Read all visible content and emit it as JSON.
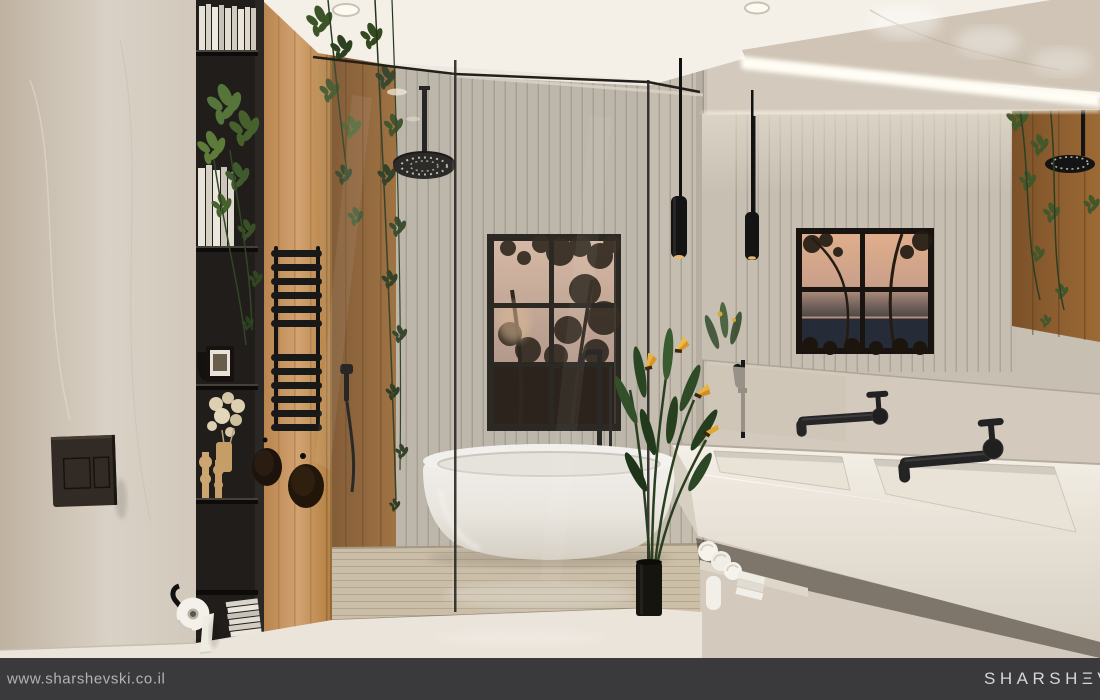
{
  "footer": {
    "website_url": "www.sharshevski.co.il",
    "brand_logo": "SHARSHΞVSKI",
    "bar_color": "#3a3a3c",
    "url_color": "#b3b3b3",
    "logo_color": "#d6d6d6"
  },
  "scene": {
    "type": "3d-interior-render",
    "room": "bathroom",
    "description": "Modern bathroom visualization: beige marble walls, black open shelving with books and decor, oak wood panel with trailing vines, glass-enclosed wet zone with black ceiling rain shower, white freestanding oval bathtub in front of a black-framed window with dusk trees, fluted slat tile wall, long backlit mirror reflecting the room, floating double-sink marble vanity with matte black wall faucets, black pendant lights, rolled towels on the vanity shelf",
    "palette": {
      "marble_wall": "#d6cec2",
      "shelf_black": "#201d1b",
      "wood_oak": "#c4955f",
      "slat_tile": "#c5beb1",
      "ceiling": "#f4f0e8",
      "tub_white": "#f7f5f1",
      "fixture_black": "#1a1a1a",
      "plant_green": "#3c5528",
      "flower_yellow": "#e7b43c",
      "floor": "#eae4da",
      "dusk_sky": "#d8b49c"
    },
    "objects": [
      "open shelf unit",
      "books",
      "trailing pothos",
      "photo frame",
      "dried pampas",
      "wood candlesticks",
      "magazines",
      "toilet flush plate",
      "toilet paper roll",
      "towel radiator",
      "rain shower head",
      "hand shower",
      "glass partition",
      "freestanding bathtub",
      "floor tub filler",
      "window with sunset trees",
      "pendant lights",
      "mirror",
      "double sink vanity",
      "wall faucets",
      "rolled towels",
      "bird of paradise plant"
    ]
  }
}
